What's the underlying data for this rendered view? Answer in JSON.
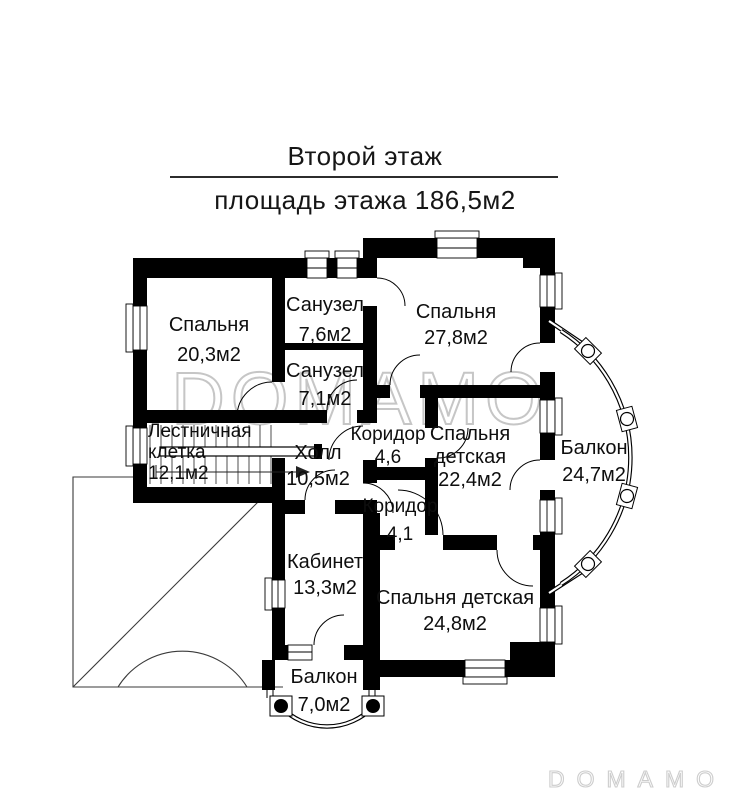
{
  "header": {
    "title": "Второй этаж",
    "subtitle": "площадь этажа  186,5м2"
  },
  "watermark": {
    "center": "DOMAMO",
    "corner": "DOMAMO"
  },
  "colors": {
    "wall": "#000000",
    "watermark_center": "#c6c6c6",
    "watermark_corner": "#cdcdcd"
  },
  "rooms": [
    {
      "id": "bedroom-1",
      "lines": [
        "Спальня",
        "20,3м2"
      ]
    },
    {
      "id": "bathroom-1",
      "lines": [
        "Санузел",
        "7,6м2"
      ]
    },
    {
      "id": "bathroom-2",
      "lines": [
        "Санузел",
        "7,1м2"
      ]
    },
    {
      "id": "bedroom-2",
      "lines": [
        "Спальня",
        "27,8м2"
      ]
    },
    {
      "id": "stairwell",
      "lines": [
        "Лестничная",
        "клетка",
        "12,1м2"
      ]
    },
    {
      "id": "hall",
      "lines": [
        "Холл",
        "10,5м2"
      ]
    },
    {
      "id": "corridor-1",
      "lines": [
        "Коридор",
        "4,6"
      ]
    },
    {
      "id": "kids-bedroom-1",
      "lines": [
        "Спальня",
        "детская",
        "22,4м2"
      ]
    },
    {
      "id": "balcony-right",
      "lines": [
        "Балкон",
        "24,7м2"
      ]
    },
    {
      "id": "corridor-2",
      "lines": [
        "Коридор",
        "4,1"
      ]
    },
    {
      "id": "study",
      "lines": [
        "Кабинет",
        "13,3м2"
      ]
    },
    {
      "id": "kids-bedroom-2",
      "lines": [
        "Спальня детская",
        "24,8м2"
      ]
    },
    {
      "id": "balcony-bottom",
      "lines": [
        "Балкон",
        "7,0м2"
      ]
    }
  ]
}
